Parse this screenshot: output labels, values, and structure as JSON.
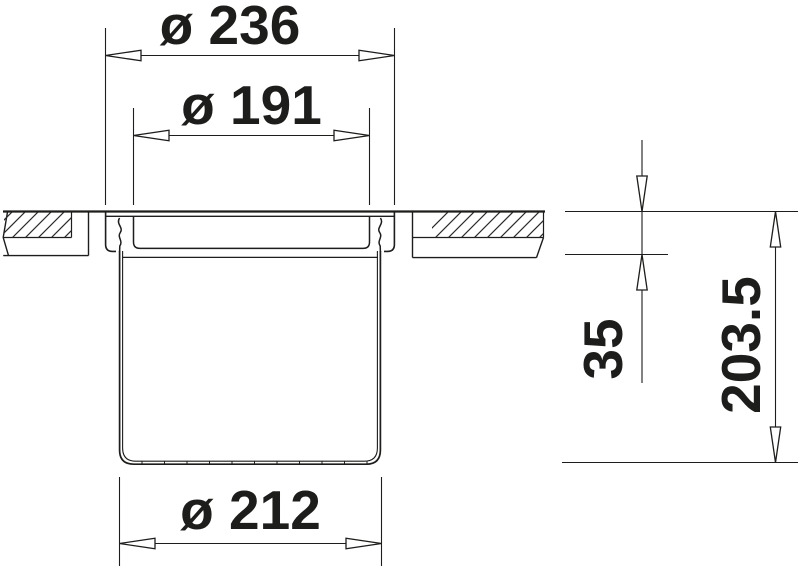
{
  "diagram": {
    "type": "technical-cross-section-drawing",
    "background_color": "#ffffff",
    "line_color": "#1d1d1b",
    "dimensions": {
      "flange_outer_diameter": "ø 236",
      "opening_inner_diameter": "ø 191",
      "base_diameter": "ø 212",
      "counter_thickness": "35",
      "total_depth": "203.5"
    }
  }
}
